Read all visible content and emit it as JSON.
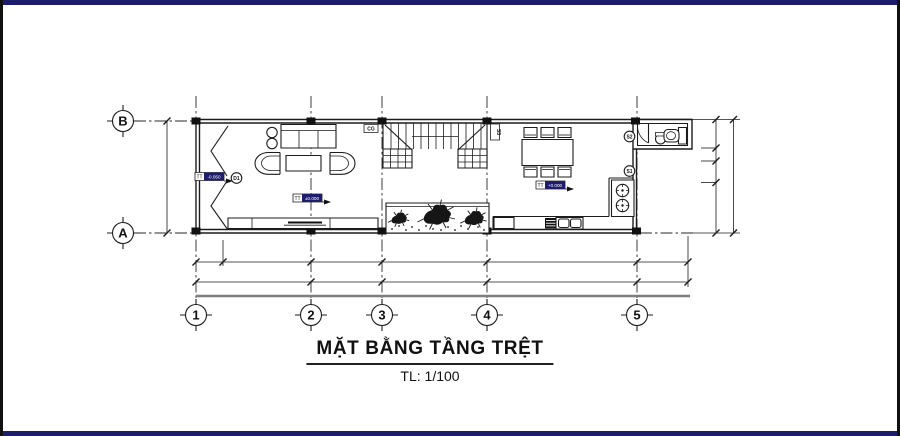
{
  "colors": {
    "navy": "#1d1d6b",
    "ink": "#1c1c1c",
    "accent": "#2563c4",
    "gray": "#7d7d7d"
  },
  "title_block": {
    "title": "MẶT BẰNG TẦNG TRỆT",
    "scale": "TL: 1/100"
  },
  "grid": {
    "rows": [
      {
        "label": "B"
      },
      {
        "label": "A"
      }
    ],
    "cols": [
      {
        "label": "1"
      },
      {
        "label": "2"
      },
      {
        "label": "3"
      },
      {
        "label": "4"
      },
      {
        "label": "5"
      }
    ]
  },
  "levels": {
    "entry": {
      "prefix": "TT",
      "value": "-0.050"
    },
    "living": {
      "prefix": "TT",
      "value": "±0.000"
    },
    "dining": {
      "prefix": "TT",
      "value": "+0.000"
    }
  },
  "tags": {
    "entry_door": "D1",
    "stair_left": "CG",
    "stair_right": "S3",
    "window_upper": "S2",
    "window_lower": "S1"
  }
}
